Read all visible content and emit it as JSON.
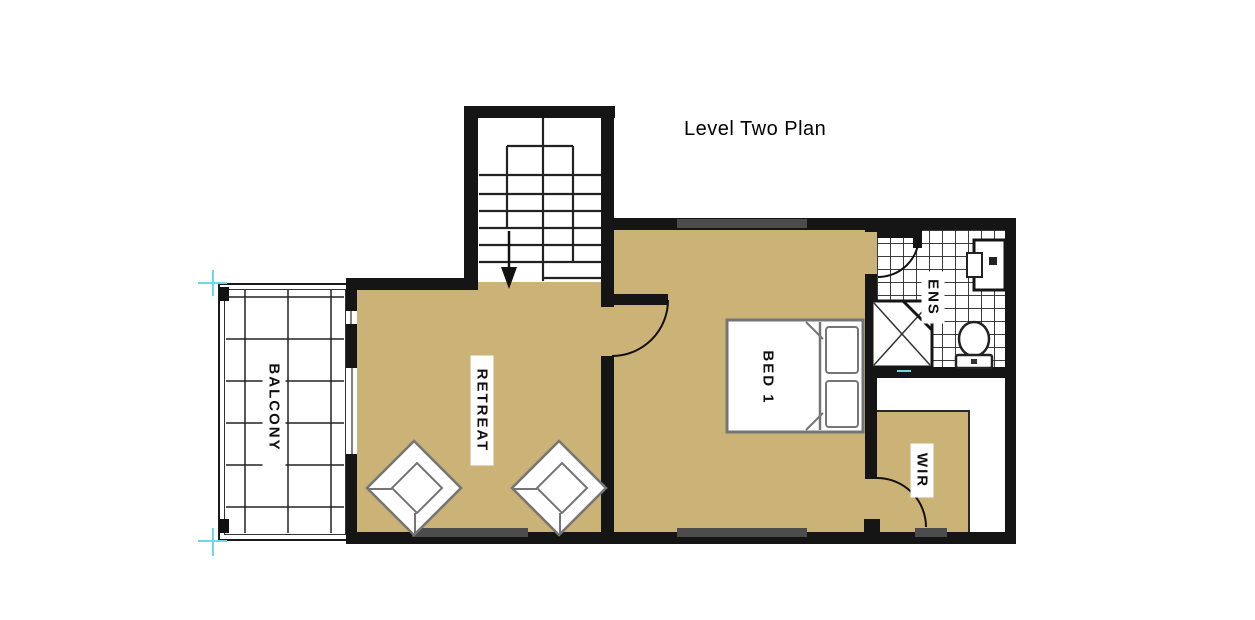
{
  "title": "Level Two Plan",
  "rooms": {
    "balcony": {
      "label": "BALCONY"
    },
    "retreat": {
      "label": "RETREAT"
    },
    "bed1": {
      "label": "BED 1"
    },
    "ens": {
      "label": "ENS"
    },
    "wir": {
      "label": "WIR"
    }
  },
  "colors": {
    "floor_tan": "#cbb276",
    "wall": "#151515",
    "line_dark": "#222222",
    "fixture_gray": "#757575",
    "window_gray": "#4c4c4c",
    "marker_cyan": "#6fd8e4"
  }
}
